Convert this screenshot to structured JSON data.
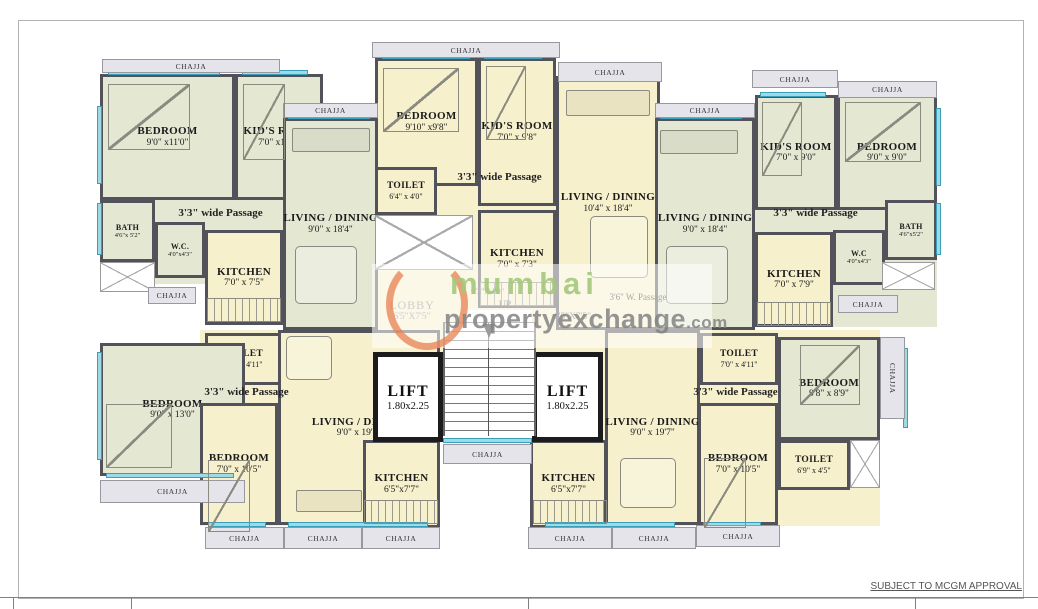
{
  "canvas": {
    "w": 1038,
    "h": 609
  },
  "colors": {
    "wall": "#52525a",
    "sage": "#e4e8d3",
    "cream": "#f6f0cd",
    "window": "#9ed9e6",
    "chajja_bg": "#e4e4ea",
    "lift_wall": "#1c1c1c",
    "watermark_green": "#a4c77b",
    "watermark_gray": "#828282",
    "watermark_orange": "#e8805a"
  },
  "chajja_label": "CHAJJA",
  "note": "SUBJECT TO MCGM APPROVAL",
  "watermark": {
    "word1": "mumbai",
    "word2": "propertyexchange",
    "suffix": ".com"
  },
  "stair": {
    "dims": "9'3\"X4'0\"",
    "up": "UP"
  },
  "lobby_left": {
    "name": "LOBBY",
    "dims": "6'5\"X7'5\""
  },
  "lobby_right": {
    "dims": "6'5\"X7'5\""
  },
  "patches": [
    {
      "x": 100,
      "y": 74,
      "w": 183,
      "h": 210,
      "fill": "sage"
    },
    {
      "x": 375,
      "y": 58,
      "w": 181,
      "h": 252,
      "fill": "cream"
    },
    {
      "x": 755,
      "y": 95,
      "w": 182,
      "h": 232,
      "fill": "sage"
    },
    {
      "x": 200,
      "y": 330,
      "w": 240,
      "h": 196,
      "fill": "cream"
    },
    {
      "x": 578,
      "y": 330,
      "w": 302,
      "h": 196,
      "fill": "cream"
    },
    {
      "x": 375,
      "y": 280,
      "w": 90,
      "h": 72,
      "fill": "cream"
    },
    {
      "x": 532,
      "y": 280,
      "w": 75,
      "h": 72,
      "fill": "cream"
    },
    {
      "x": 607,
      "y": 283,
      "w": 95,
      "h": 47,
      "fill": "sage"
    }
  ],
  "rooms": [
    {
      "id": "bedroom-top-left",
      "name": "BEDROOM",
      "dims": "9'0\" x11'0\"",
      "x": 100,
      "y": 74,
      "w": 135,
      "h": 126,
      "fill": "sage",
      "size": "l"
    },
    {
      "id": "kids-room-top-left",
      "name": "KID'S ROOM",
      "dims": "7'0\" x11'0\"",
      "x": 235,
      "y": 74,
      "w": 88,
      "h": 126,
      "fill": "sage",
      "size": "l"
    },
    {
      "id": "living-dining-top-left",
      "name": "LIVING / DINING",
      "dims": "9'0\" x 18'4\"",
      "x": 283,
      "y": 118,
      "w": 95,
      "h": 212,
      "fill": "sage",
      "size": "l"
    },
    {
      "id": "bath-top-left",
      "name": "BATH",
      "dims": "4'6\"x 5'2\"",
      "x": 100,
      "y": 200,
      "w": 55,
      "h": 62,
      "fill": "sage",
      "size": "s"
    },
    {
      "id": "wc-top-left",
      "name": "W.C.",
      "dims": "4'0\"x4'3\"",
      "x": 155,
      "y": 222,
      "w": 50,
      "h": 56,
      "fill": "sage",
      "size": "s"
    },
    {
      "id": "kitchen-top-left",
      "name": "KITCHEN",
      "dims": "7'0\" x 7'5\"",
      "x": 205,
      "y": 230,
      "w": 78,
      "h": 95,
      "fill": "cream",
      "size": "l"
    },
    {
      "id": "bedroom-top-mid",
      "name": "BEDROOM",
      "dims": "9'10\" x9'8\"",
      "x": 375,
      "y": 58,
      "w": 103,
      "h": 128,
      "fill": "cream",
      "size": "l"
    },
    {
      "id": "kids-room-top-mid",
      "name": "KID'S ROOM",
      "dims": "7'0\" x 9'8\"",
      "x": 478,
      "y": 58,
      "w": 78,
      "h": 148,
      "fill": "cream",
      "size": "l"
    },
    {
      "id": "toilet-top-mid",
      "name": "TOILET",
      "dims": "6'4\" x 4'0\"",
      "x": 375,
      "y": 167,
      "w": 62,
      "h": 48,
      "fill": "cream",
      "size": "m"
    },
    {
      "id": "kitchen-top-mid",
      "name": "KITCHEN",
      "dims": "7'0\" x 7'3\"",
      "x": 478,
      "y": 210,
      "w": 78,
      "h": 98,
      "fill": "cream",
      "size": "l"
    },
    {
      "id": "living-dining-top-mid",
      "name": "LIVING / DINING",
      "dims": "10'4\" x 18'4\"",
      "x": 556,
      "y": 76,
      "w": 104,
      "h": 254,
      "fill": "cream",
      "size": "l"
    },
    {
      "id": "living-dining-top-right",
      "name": "LIVING / DINING",
      "dims": "9'0\" x 18'4\"",
      "x": 655,
      "y": 118,
      "w": 100,
      "h": 212,
      "fill": "sage",
      "size": "l"
    },
    {
      "id": "kids-room-top-right",
      "name": "KID'S ROOM",
      "dims": "7'0\" x 9'0\"",
      "x": 755,
      "y": 95,
      "w": 82,
      "h": 115,
      "fill": "sage",
      "size": "l"
    },
    {
      "id": "bedroom-top-right",
      "name": "BEDROOM",
      "dims": "9'0\" x 9'0\"",
      "x": 837,
      "y": 95,
      "w": 100,
      "h": 115,
      "fill": "sage",
      "size": "l"
    },
    {
      "id": "bath-top-right",
      "name": "BATH",
      "dims": "4'6\"x5'2\"",
      "x": 885,
      "y": 200,
      "w": 52,
      "h": 60,
      "fill": "sage",
      "size": "s"
    },
    {
      "id": "wc-top-right",
      "name": "W.C",
      "dims": "4'0\"x4'3\"",
      "x": 833,
      "y": 230,
      "w": 52,
      "h": 55,
      "fill": "sage",
      "size": "s"
    },
    {
      "id": "kitchen-top-right",
      "name": "KITCHEN",
      "dims": "7'0\" x 7'9\"",
      "x": 755,
      "y": 232,
      "w": 78,
      "h": 95,
      "fill": "cream",
      "size": "l"
    },
    {
      "id": "toilet-bottom-left",
      "name": "TOILET",
      "dims": "7'0\" x 4'11\"",
      "x": 205,
      "y": 333,
      "w": 78,
      "h": 52,
      "fill": "cream",
      "size": "m"
    },
    {
      "id": "bedroom1-bottom-left",
      "name": "BEDROOM",
      "dims": "9'0\" x 13'0\"",
      "x": 100,
      "y": 343,
      "w": 145,
      "h": 133,
      "fill": "sage",
      "size": "l"
    },
    {
      "id": "bedroom2-bottom-left",
      "name": "BEDROOM",
      "dims": "7'0\" x 10'5\"",
      "x": 200,
      "y": 403,
      "w": 78,
      "h": 122,
      "fill": "cream",
      "size": "l"
    },
    {
      "id": "living-dining-bottom-left",
      "name": "LIVING / DINING",
      "dims": "9'0\" x 19'7\"",
      "x": 278,
      "y": 330,
      "w": 162,
      "h": 195,
      "fill": "cream",
      "size": "l"
    },
    {
      "id": "kitchen-bottom-left",
      "name": "KITCHEN",
      "dims": "6'5\"x7'7\"",
      "x": 363,
      "y": 440,
      "w": 77,
      "h": 88,
      "fill": "cream",
      "size": "l"
    },
    {
      "id": "living-dining-bottom-right",
      "name": "LIVING / DINING",
      "dims": "9'0\" x 19'7\"",
      "x": 605,
      "y": 330,
      "w": 95,
      "h": 195,
      "fill": "cream",
      "size": "l"
    },
    {
      "id": "toilet-bottom-right",
      "name": "TOILET",
      "dims": "7'0\" x 4'11\"",
      "x": 700,
      "y": 333,
      "w": 78,
      "h": 52,
      "fill": "cream",
      "size": "m"
    },
    {
      "id": "bedroom2-bottom-right",
      "name": "BEDROOM",
      "dims": "7'0\" x 10'5\"",
      "x": 698,
      "y": 403,
      "w": 80,
      "h": 122,
      "fill": "cream",
      "size": "l"
    },
    {
      "id": "bedroom1-bottom-right",
      "name": "BEDROOM",
      "dims": "9'8\" x 8'9\"",
      "x": 778,
      "y": 337,
      "w": 102,
      "h": 103,
      "fill": "sage",
      "size": "l"
    },
    {
      "id": "toilet2-bottom-right",
      "name": "TOILET",
      "dims": "6'9\" x 4'5\"",
      "x": 778,
      "y": 440,
      "w": 72,
      "h": 50,
      "fill": "cream",
      "size": "m"
    },
    {
      "id": "kitchen-bottom-right",
      "name": "KITCHEN",
      "dims": "6'5\"x7'7\"",
      "x": 530,
      "y": 440,
      "w": 77,
      "h": 88,
      "fill": "cream",
      "size": "l"
    }
  ],
  "lifts": [
    {
      "label": "LIFT",
      "dims": "1.80x2.25",
      "x": 373,
      "y": 352,
      "w": 70,
      "h": 90
    },
    {
      "label": "LIFT",
      "dims": "1.80x2.25",
      "x": 532,
      "y": 352,
      "w": 71,
      "h": 90
    }
  ],
  "chajjas": [
    {
      "x": 102,
      "y": 59,
      "w": 178,
      "h": 14
    },
    {
      "x": 283,
      "y": 103,
      "w": 95,
      "h": 15
    },
    {
      "x": 372,
      "y": 42,
      "w": 188,
      "h": 16
    },
    {
      "x": 558,
      "y": 62,
      "w": 104,
      "h": 20
    },
    {
      "x": 655,
      "y": 103,
      "w": 100,
      "h": 15
    },
    {
      "x": 752,
      "y": 70,
      "w": 86,
      "h": 18
    },
    {
      "x": 838,
      "y": 81,
      "w": 99,
      "h": 17
    },
    {
      "x": 148,
      "y": 287,
      "w": 48,
      "h": 17
    },
    {
      "x": 838,
      "y": 295,
      "w": 60,
      "h": 18
    },
    {
      "x": 100,
      "y": 480,
      "w": 145,
      "h": 23
    },
    {
      "x": 205,
      "y": 527,
      "w": 79,
      "h": 22
    },
    {
      "x": 284,
      "y": 527,
      "w": 78,
      "h": 22
    },
    {
      "x": 362,
      "y": 527,
      "w": 78,
      "h": 22
    },
    {
      "x": 443,
      "y": 444,
      "w": 89,
      "h": 20
    },
    {
      "x": 528,
      "y": 527,
      "w": 84,
      "h": 22
    },
    {
      "x": 612,
      "y": 527,
      "w": 84,
      "h": 22
    },
    {
      "x": 696,
      "y": 525,
      "w": 84,
      "h": 22
    },
    {
      "x": 880,
      "y": 337,
      "w": 25,
      "h": 82,
      "vertical": true
    }
  ],
  "passages": [
    {
      "text": "3'3\" wide Passage",
      "x": 158,
      "y": 207,
      "w": 125
    },
    {
      "text": "3'3\" wide Passage",
      "x": 437,
      "y": 171,
      "w": 125
    },
    {
      "text": "3'3\" wide Passage",
      "x": 753,
      "y": 207,
      "w": 125
    },
    {
      "text": "3'3\" wide Passage",
      "x": 184,
      "y": 386,
      "w": 125
    },
    {
      "text": "3'3\" wide Passage",
      "x": 673,
      "y": 386,
      "w": 125
    },
    {
      "text": "3'6\" W. Passage",
      "x": 583,
      "y": 292,
      "w": 110,
      "small": true
    }
  ],
  "voids": [
    {
      "x": 100,
      "y": 262,
      "w": 55,
      "h": 30
    },
    {
      "x": 375,
      "y": 215,
      "w": 98,
      "h": 55
    },
    {
      "x": 882,
      "y": 262,
      "w": 53,
      "h": 28
    },
    {
      "x": 850,
      "y": 440,
      "w": 30,
      "h": 48
    }
  ],
  "windows": [
    {
      "x": 108,
      "y": 70,
      "w": 112,
      "h": 5
    },
    {
      "x": 242,
      "y": 70,
      "w": 66,
      "h": 5
    },
    {
      "x": 288,
      "y": 114,
      "w": 82,
      "h": 5
    },
    {
      "x": 97,
      "y": 106,
      "w": 5,
      "h": 78
    },
    {
      "x": 97,
      "y": 203,
      "w": 5,
      "h": 52
    },
    {
      "x": 382,
      "y": 54,
      "w": 88,
      "h": 5
    },
    {
      "x": 484,
      "y": 54,
      "w": 58,
      "h": 5
    },
    {
      "x": 562,
      "y": 72,
      "w": 90,
      "h": 5
    },
    {
      "x": 660,
      "y": 114,
      "w": 82,
      "h": 5
    },
    {
      "x": 760,
      "y": 92,
      "w": 66,
      "h": 5
    },
    {
      "x": 843,
      "y": 92,
      "w": 80,
      "h": 5
    },
    {
      "x": 936,
      "y": 108,
      "w": 5,
      "h": 78
    },
    {
      "x": 936,
      "y": 203,
      "w": 5,
      "h": 52
    },
    {
      "x": 97,
      "y": 352,
      "w": 5,
      "h": 108
    },
    {
      "x": 106,
      "y": 473,
      "w": 128,
      "h": 5
    },
    {
      "x": 208,
      "y": 522,
      "w": 58,
      "h": 5
    },
    {
      "x": 288,
      "y": 522,
      "w": 140,
      "h": 5
    },
    {
      "x": 443,
      "y": 438,
      "w": 89,
      "h": 5
    },
    {
      "x": 545,
      "y": 522,
      "w": 130,
      "h": 5
    },
    {
      "x": 703,
      "y": 522,
      "w": 58,
      "h": 5
    },
    {
      "x": 903,
      "y": 348,
      "w": 5,
      "h": 80
    }
  ],
  "furniture": [
    {
      "type": "bed",
      "x": 108,
      "y": 84,
      "w": 82,
      "h": 66
    },
    {
      "type": "bed",
      "x": 243,
      "y": 84,
      "w": 42,
      "h": 76
    },
    {
      "type": "sofa",
      "x": 292,
      "y": 128,
      "w": 78,
      "h": 24
    },
    {
      "type": "table",
      "x": 295,
      "y": 246,
      "w": 62,
      "h": 58
    },
    {
      "type": "bed",
      "x": 383,
      "y": 68,
      "w": 76,
      "h": 64
    },
    {
      "type": "bed",
      "x": 486,
      "y": 66,
      "w": 40,
      "h": 74
    },
    {
      "type": "sofa",
      "x": 566,
      "y": 90,
      "w": 84,
      "h": 26
    },
    {
      "type": "table",
      "x": 590,
      "y": 216,
      "w": 58,
      "h": 62
    },
    {
      "type": "bed",
      "x": 762,
      "y": 102,
      "w": 40,
      "h": 74
    },
    {
      "type": "bed",
      "x": 845,
      "y": 102,
      "w": 76,
      "h": 60
    },
    {
      "type": "sofa",
      "x": 660,
      "y": 130,
      "w": 78,
      "h": 24
    },
    {
      "type": "table",
      "x": 666,
      "y": 246,
      "w": 62,
      "h": 58
    },
    {
      "type": "bed",
      "x": 106,
      "y": 404,
      "w": 66,
      "h": 64
    },
    {
      "type": "bed",
      "x": 208,
      "y": 460,
      "w": 42,
      "h": 72
    },
    {
      "type": "table",
      "x": 286,
      "y": 336,
      "w": 46,
      "h": 44
    },
    {
      "type": "sofa",
      "x": 296,
      "y": 490,
      "w": 66,
      "h": 22
    },
    {
      "type": "table",
      "x": 620,
      "y": 458,
      "w": 56,
      "h": 50
    },
    {
      "type": "bed",
      "x": 800,
      "y": 345,
      "w": 60,
      "h": 60
    },
    {
      "type": "bed",
      "x": 704,
      "y": 458,
      "w": 42,
      "h": 70
    },
    {
      "type": "counter",
      "x": 207,
      "y": 298,
      "w": 74,
      "h": 24
    },
    {
      "type": "counter",
      "x": 480,
      "y": 282,
      "w": 74,
      "h": 24
    },
    {
      "type": "counter",
      "x": 757,
      "y": 302,
      "w": 74,
      "h": 24
    },
    {
      "type": "counter",
      "x": 364,
      "y": 500,
      "w": 74,
      "h": 24
    },
    {
      "type": "counter",
      "x": 533,
      "y": 500,
      "w": 74,
      "h": 24
    }
  ],
  "titleblock": {
    "line_y": 597,
    "ticks_x": [
      13,
      131,
      528,
      915
    ]
  }
}
